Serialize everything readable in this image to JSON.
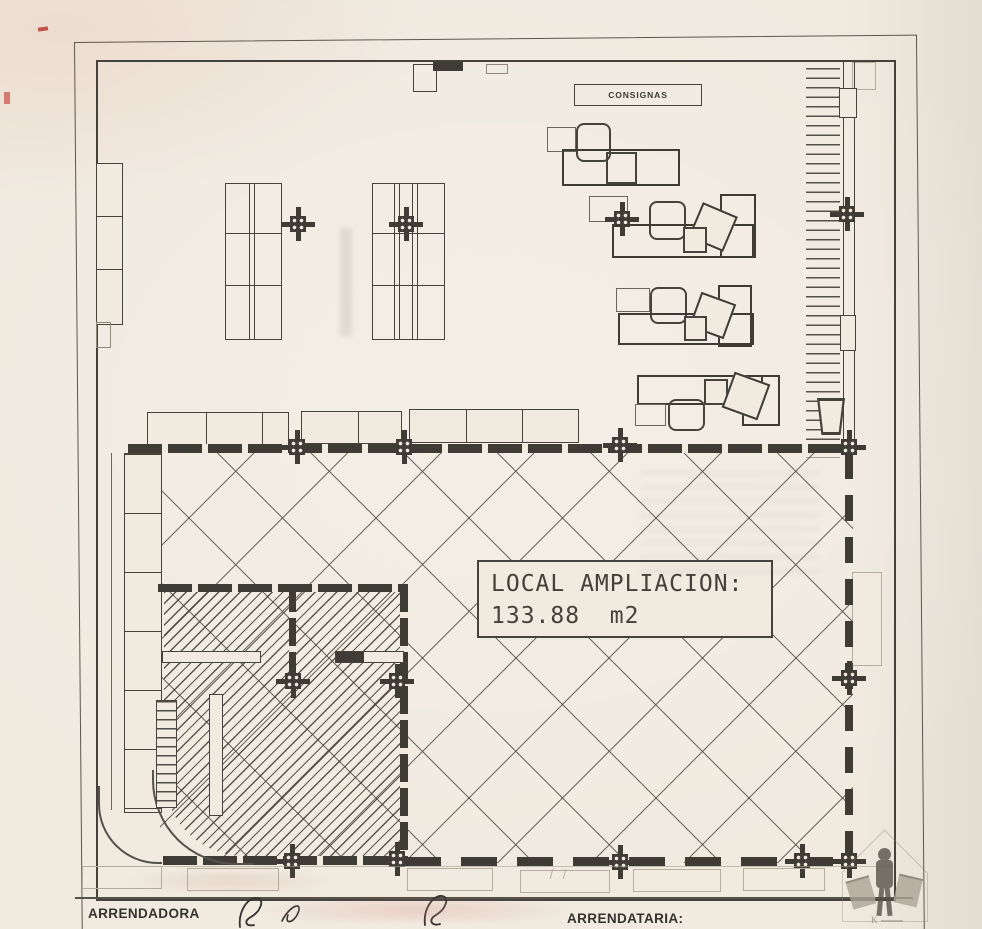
{
  "plan": {
    "consignas_label": "CONSIGNAS",
    "local_label_line1": "LOCAL AMPLIACION:",
    "local_label_line2": "133.88  m2"
  },
  "footer": {
    "arrendadora": "ARRENDADORA",
    "arrendataria": "ARRENDATARIA:"
  },
  "watermark": {
    "letter": "K"
  },
  "colors": {
    "paper": "#f0eadf",
    "ink": "#46433d",
    "wall": "#3f3c36",
    "red_mark": "#b8382e"
  }
}
